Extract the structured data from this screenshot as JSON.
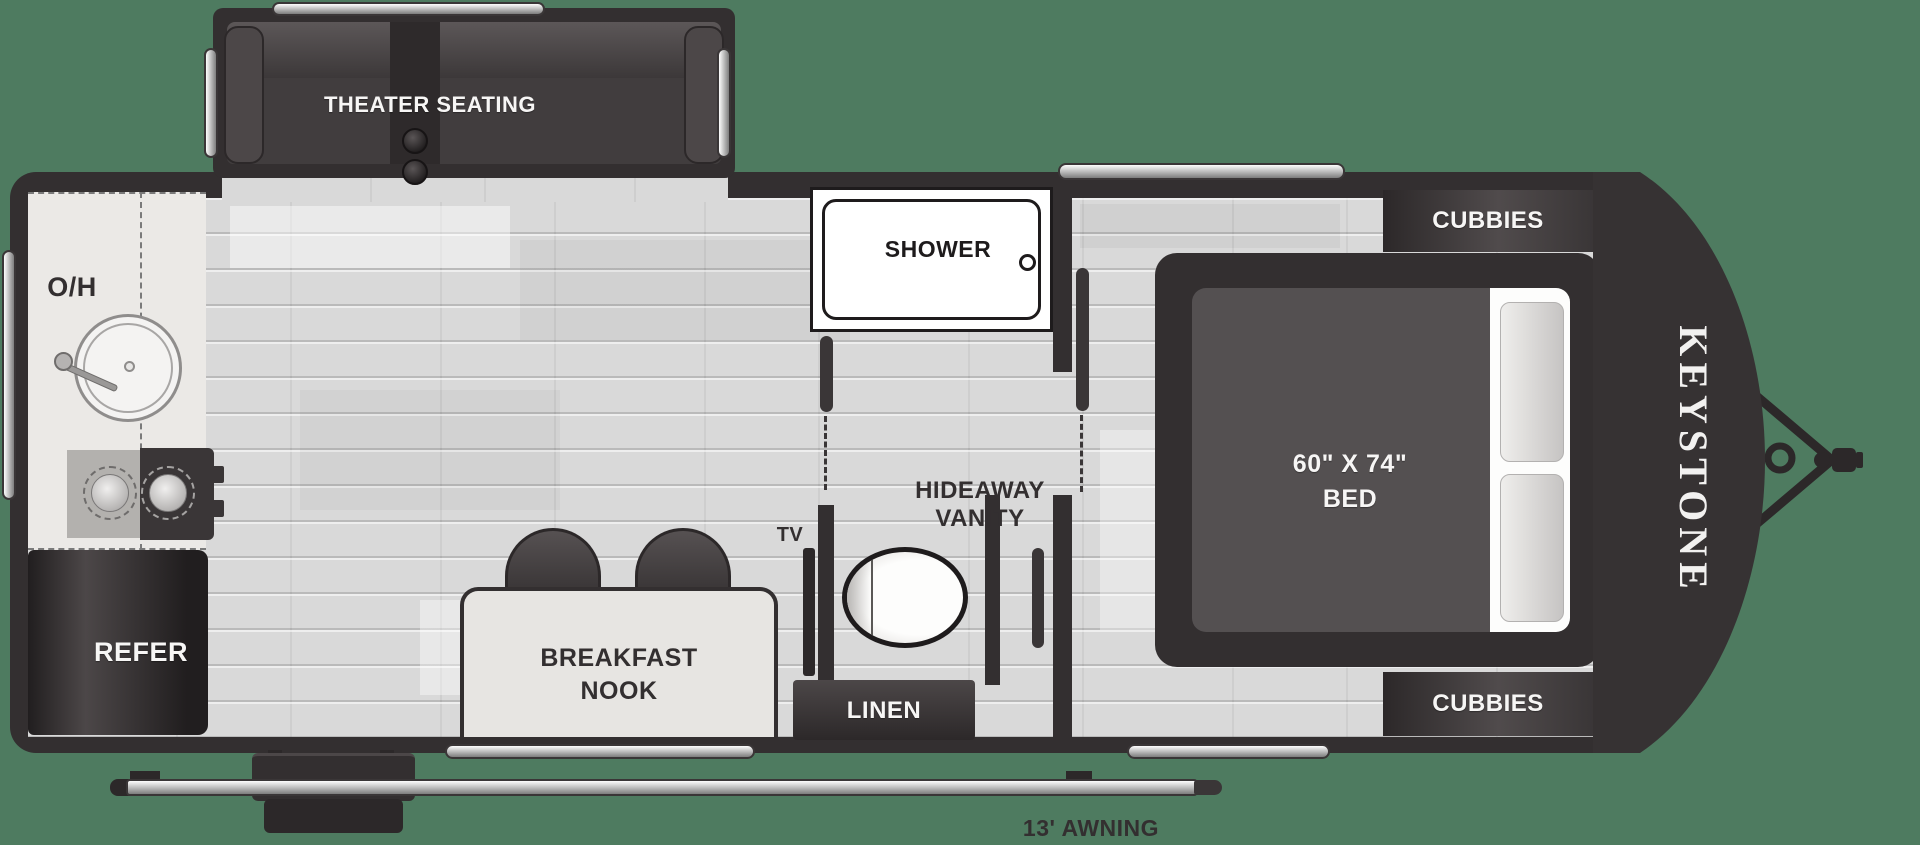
{
  "meta": {
    "type": "travel-trailer-floorplan",
    "brand": "KEYSTONE"
  },
  "labels": {
    "theater_seating": "THEATER SEATING",
    "overhead_cabinet": "O/H",
    "refrigerator": "REFER",
    "shower": "SHOWER",
    "hideaway_vanity_line1": "HIDEAWAY",
    "hideaway_vanity_line2": "VANITY",
    "tv": "TV",
    "breakfast_nook_line1": "BREAKFAST",
    "breakfast_nook_line2": "NOOK",
    "linen": "LINEN",
    "bed_size": "60\" X 74\"",
    "bed": "BED",
    "cubbies_top": "CUBBIES",
    "cubbies_bottom": "CUBBIES",
    "brand_logo": "KEYSTONE",
    "awning": "13' AWNING",
    "awning_clipped_line": "13' AWNING"
  },
  "colors": {
    "background": "#4e7b60",
    "walls": "#332f30",
    "floor": "#d9d9d9",
    "counter": "#ebe9e6",
    "fixture_white": "#ffffff",
    "label_dark": "#332f30",
    "label_light": "#f7f6f5"
  }
}
